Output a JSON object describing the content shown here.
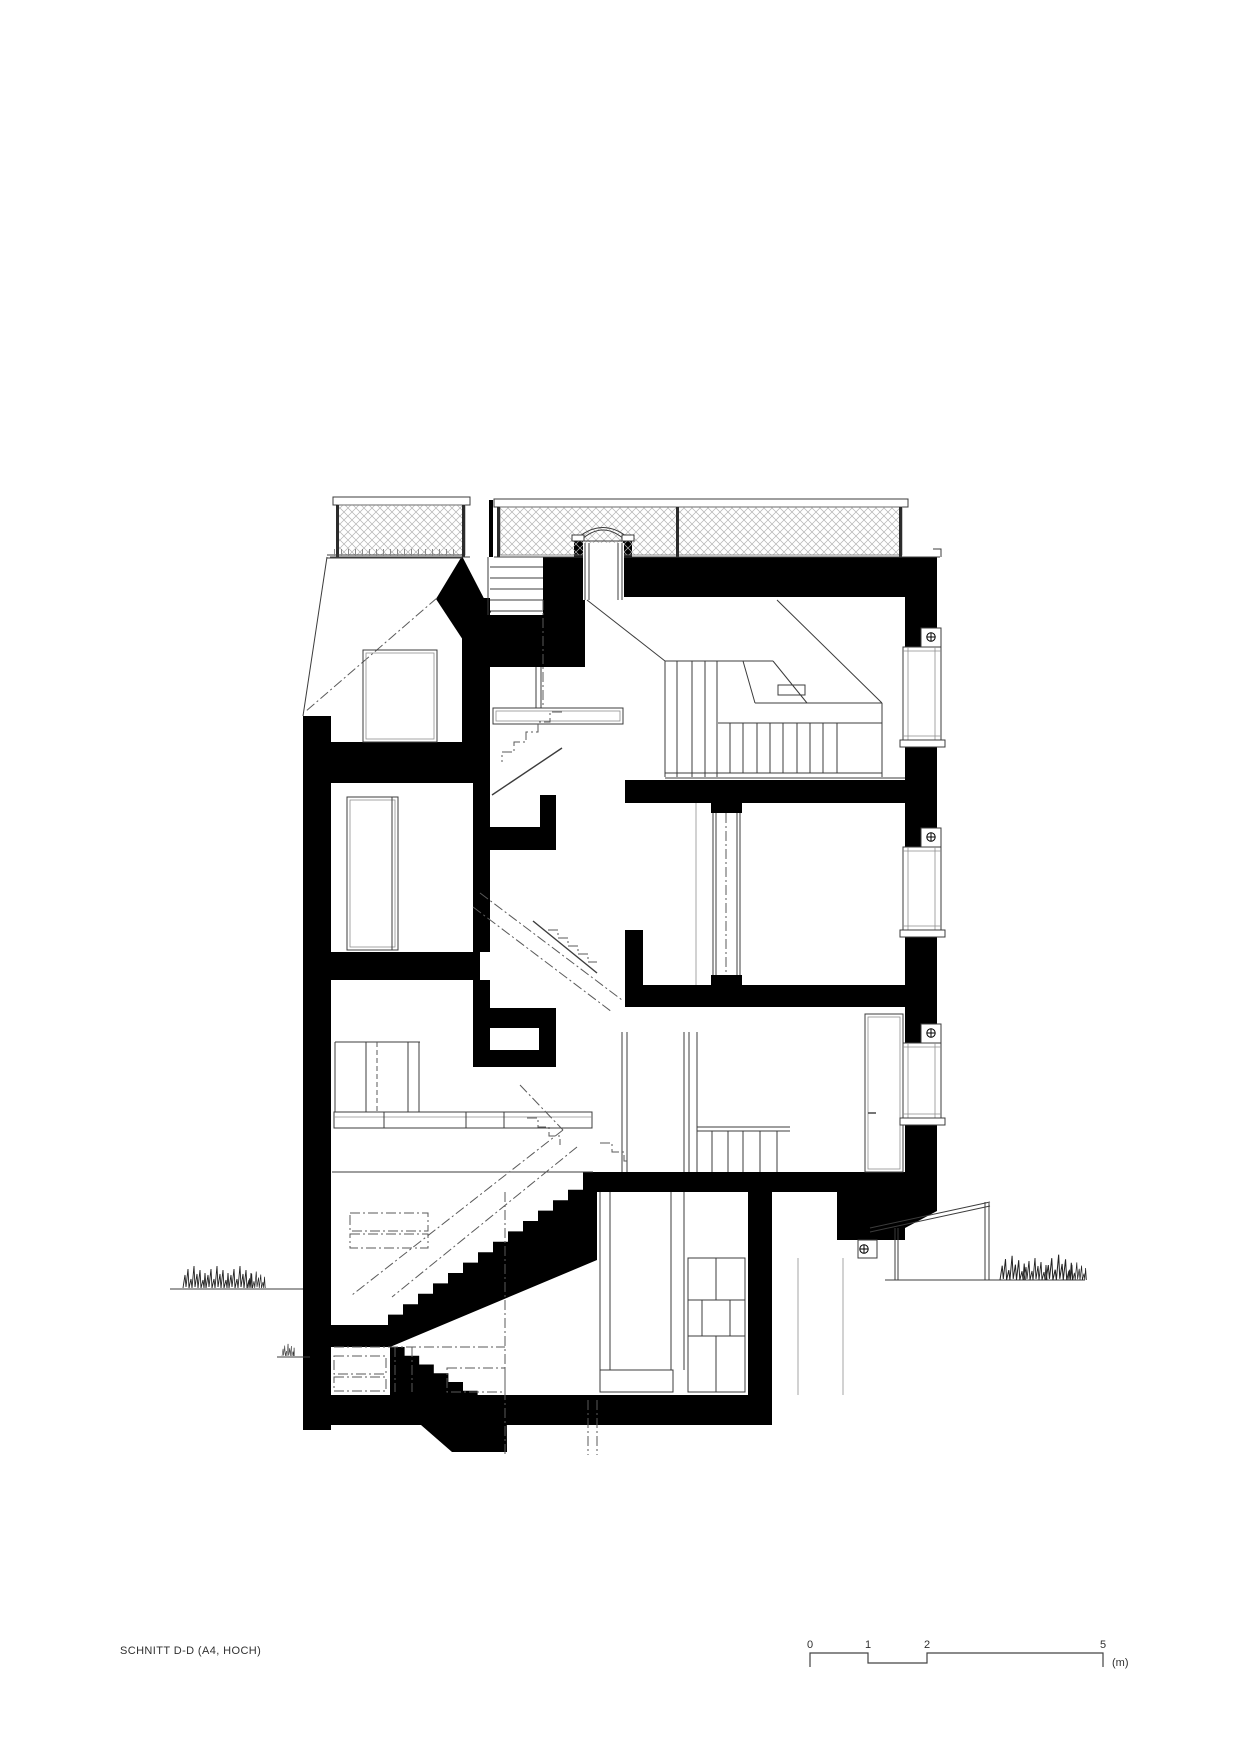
{
  "page": {
    "background": "#ffffff"
  },
  "title_block": {
    "label": "SCHNITT D-D (A4, HOCH)"
  },
  "scale_bar": {
    "tick0": "0",
    "tick1": "1",
    "tick2": "2",
    "tick3": "5",
    "unit": "(m)"
  },
  "drawing": {
    "type": "architectural-section-drawing",
    "poche_color": "#000000",
    "line_color": "#3c3c3c",
    "mesh_color": "#b3b3b3",
    "levels": [
      "roof-terrace",
      "attic",
      "upper-floor",
      "entry-floor",
      "garden-floor",
      "basement"
    ]
  }
}
